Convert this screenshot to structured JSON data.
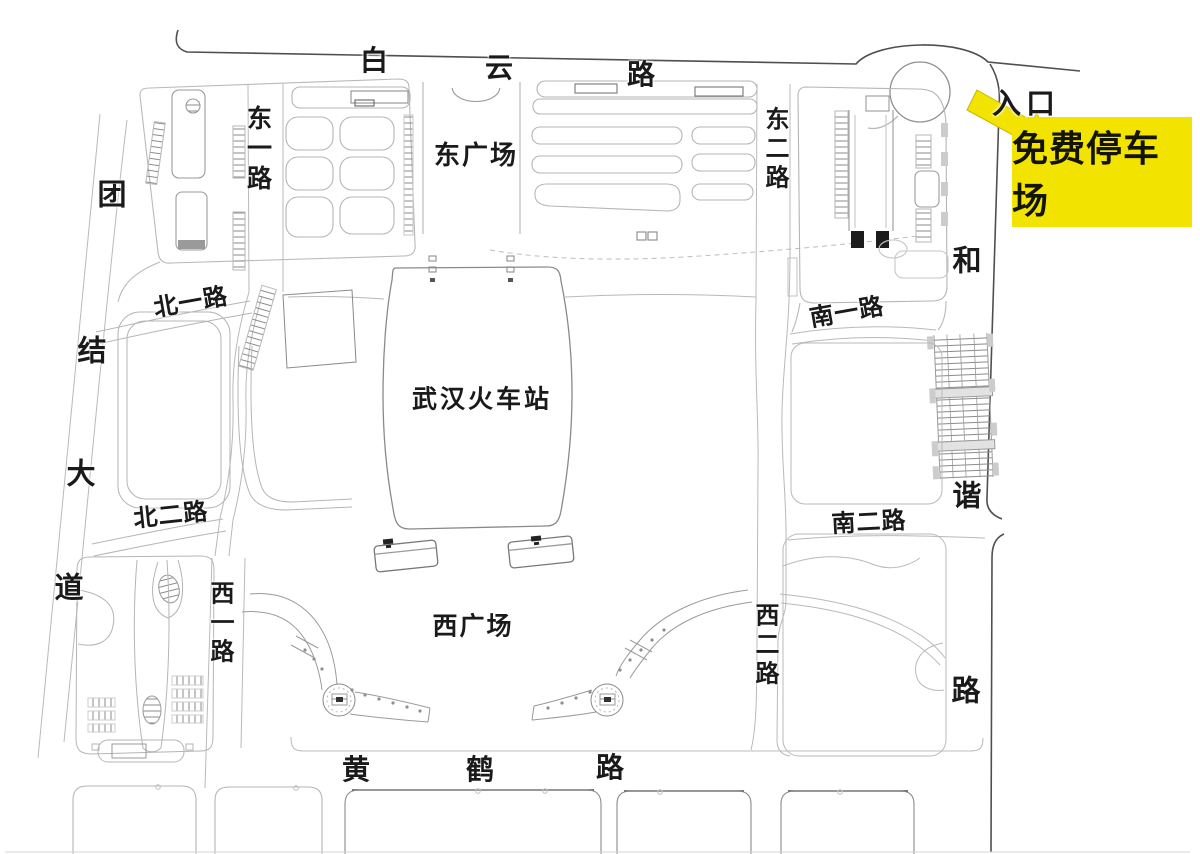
{
  "map": {
    "title": "武汉火车站停车示意图",
    "station": {
      "label": "武汉火车站"
    },
    "plazas": {
      "east": "东广场",
      "west": "西广场"
    },
    "entrance": {
      "label": "入口"
    },
    "parking_sign": {
      "label": "免费停车场"
    },
    "roads": {
      "baiyun": {
        "name": "白云路",
        "chars": [
          "白",
          "云",
          "路"
        ]
      },
      "tuanjie": {
        "name": "团结大道",
        "chars": [
          "团",
          "结",
          "大",
          "道"
        ]
      },
      "huanghe": {
        "name": "黄鹤路",
        "chars": [
          "黄",
          "鹤",
          "路"
        ]
      },
      "hexie": {
        "name": "和谐路",
        "chars": [
          "和",
          "谐",
          "路"
        ]
      },
      "dongyi": {
        "name": "东一路"
      },
      "donger": {
        "name": "东二路"
      },
      "xiyi": {
        "name": "西一路"
      },
      "xier": {
        "name": "西二路"
      },
      "beiyi": {
        "name": "北一路"
      },
      "beier": {
        "name": "北二路"
      },
      "nanyi": {
        "name": "南一路"
      },
      "naner": {
        "name": "南二路"
      }
    },
    "palette": {
      "sign_bg": "#F2E300",
      "sign_text": "#141404",
      "arrow_fill": "#F2E300",
      "line_dark": "#4f4f4f",
      "line_mid": "#8f8f8f",
      "line_light": "#b9b9b9",
      "label_color": "#1a1a1a"
    }
  }
}
